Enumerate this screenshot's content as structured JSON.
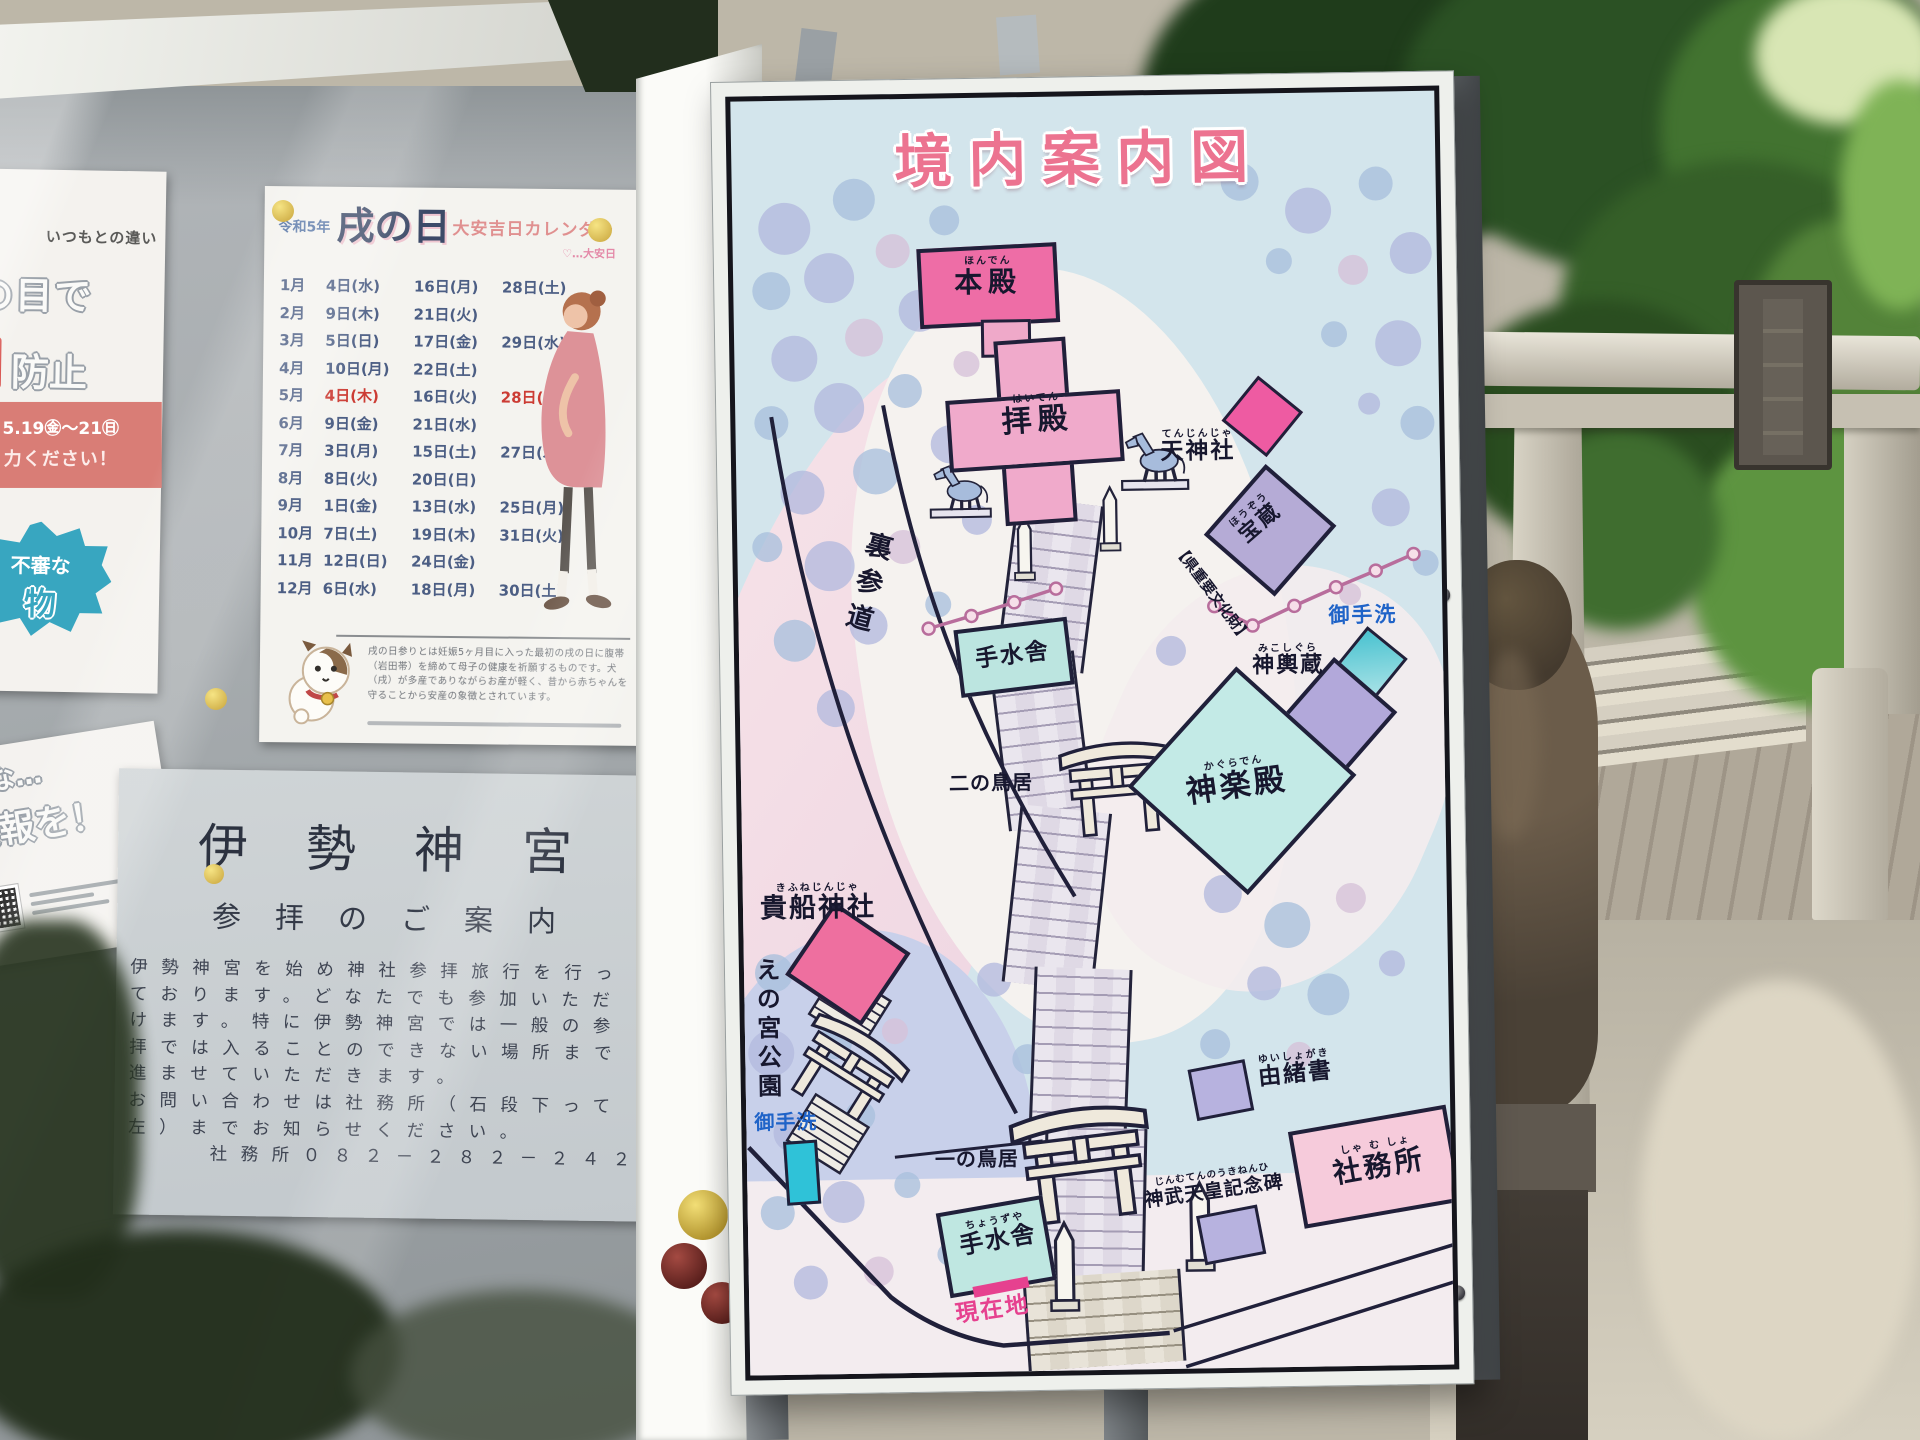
{
  "map_sign": {
    "title": "境内案内図",
    "labels": {
      "honden": {
        "furi": "ほんでん",
        "label": "本殿"
      },
      "haiden": {
        "furi": "はいでん",
        "label": "拝殿"
      },
      "tenjinja": {
        "furi": "てんじんじゃ",
        "label": "天神社"
      },
      "hozo": {
        "furi": "ほうぞう",
        "label": "宝蔵"
      },
      "bunkazai": "【県重要文化財】",
      "mitarashi_right": "御手洗",
      "mikoshigura": {
        "furi": "みこしぐら",
        "label": "神輿蔵"
      },
      "kaguraden": {
        "furi": "かぐらでん",
        "label": "神楽殿"
      },
      "urasando": "裏参道",
      "temizusha_mid": "手水舎",
      "ni_no_torii": "二の鳥居",
      "kifune": {
        "furi": "きふねじんじゃ",
        "label": "貴船神社"
      },
      "enomiya": "えの宮公園",
      "mitarashi_left": "御手洗",
      "ichi_no_torii": "一の鳥居",
      "yuishogaki": {
        "furi": "ゆいしょがき",
        "label": "由緒書"
      },
      "jinmu": {
        "furi": "じんむてんのうきねんひ",
        "label": "神武天皇記念碑"
      },
      "shamusho": {
        "furi": "しゃ む しょ",
        "label": "社務所"
      },
      "temizusha_bottom": {
        "furi": "ちょうずや",
        "label": "手水舎"
      },
      "genzaichi": "現在地"
    },
    "colors": {
      "title_pink": "#ec7390",
      "building_pink": "#ee6da6",
      "building_light_pink": "#f0aacb",
      "teal": "#bfe6e0",
      "lavender": "#b7b2df",
      "blue_text": "#1f63c8",
      "genzaichi_pink": "#e6418f"
    }
  },
  "notice_board": {
    "calendar": {
      "era_year": "令和5年",
      "title_main": "戌の日",
      "title_sub": "大安吉日カレンダー",
      "heart_note": "♡…大安日",
      "rows": [
        {
          "month": "1月",
          "dates": [
            {
              "t": "4日(水)"
            },
            {
              "t": "16日(月)"
            },
            {
              "t": "28日(土)"
            }
          ]
        },
        {
          "month": "2月",
          "dates": [
            {
              "t": "9日(木)"
            },
            {
              "t": "21日(火)"
            }
          ]
        },
        {
          "month": "3月",
          "dates": [
            {
              "t": "5日(日)"
            },
            {
              "t": "17日(金)"
            },
            {
              "t": "29日(水)"
            }
          ]
        },
        {
          "month": "4月",
          "dates": [
            {
              "t": "10日(月)"
            },
            {
              "t": "22日(土)"
            }
          ]
        },
        {
          "month": "5月",
          "dates": [
            {
              "t": "4日(木)",
              "hl": true
            },
            {
              "t": "16日(火)"
            },
            {
              "t": "28日(日)",
              "hl": true
            }
          ]
        },
        {
          "month": "6月",
          "dates": [
            {
              "t": "9日(金)"
            },
            {
              "t": "21日(水)"
            }
          ]
        },
        {
          "month": "7月",
          "dates": [
            {
              "t": "3日(月)"
            },
            {
              "t": "15日(土)"
            },
            {
              "t": "27日(木)"
            }
          ]
        },
        {
          "month": "8月",
          "dates": [
            {
              "t": "8日(火)"
            },
            {
              "t": "20日(日)"
            }
          ]
        },
        {
          "month": "9月",
          "dates": [
            {
              "t": "1日(金)"
            },
            {
              "t": "13日(水)"
            },
            {
              "t": "25日(月)"
            }
          ]
        },
        {
          "month": "10月",
          "dates": [
            {
              "t": "7日(土)"
            },
            {
              "t": "19日(木)"
            },
            {
              "t": "31日(火)"
            }
          ]
        },
        {
          "month": "11月",
          "dates": [
            {
              "t": "12日(日)"
            },
            {
              "t": "24日(金)"
            }
          ]
        },
        {
          "month": "12月",
          "dates": [
            {
              "t": "6日(水)"
            },
            {
              "t": "18日(月)"
            },
            {
              "t": "30日(土)"
            }
          ]
        }
      ],
      "note": "戌の日参りとは妊娠5ヶ月目に入った最初の戌の日に腹帯（岩田帯）を締めて母子の健康を祈願するものです。犬（戌）が多産でありながらお産が軽く、昔から赤ちゃんを守ることから安産の象徴とされています。"
    },
    "ise_notice": {
      "title": "伊勢神宮",
      "subtitle": "参拝のご案内",
      "body_lines": [
        "伊勢神宮を始め神社参拝旅行を行っ",
        "ております。どなたでも参加いただ",
        "けます。特に伊勢神宮では一般の参",
        "拝では入ることのできない場所まで",
        "進ませていただきます。",
        "お問い合わせは社務所（石段下って",
        "左）までお知らせください。"
      ],
      "phone_line": "社務所０８２－２８２－２４２７"
    },
    "left_poster": {
      "line1": "いつもとの違い",
      "line2": "の目で",
      "line3": "防止",
      "period": "5.19㊎〜21㊐",
      "ask": "力ください！",
      "fushin": "不審な",
      "mono": "物"
    },
    "report_poster": {
      "line1": "うな…",
      "line2": "通報を！"
    }
  }
}
